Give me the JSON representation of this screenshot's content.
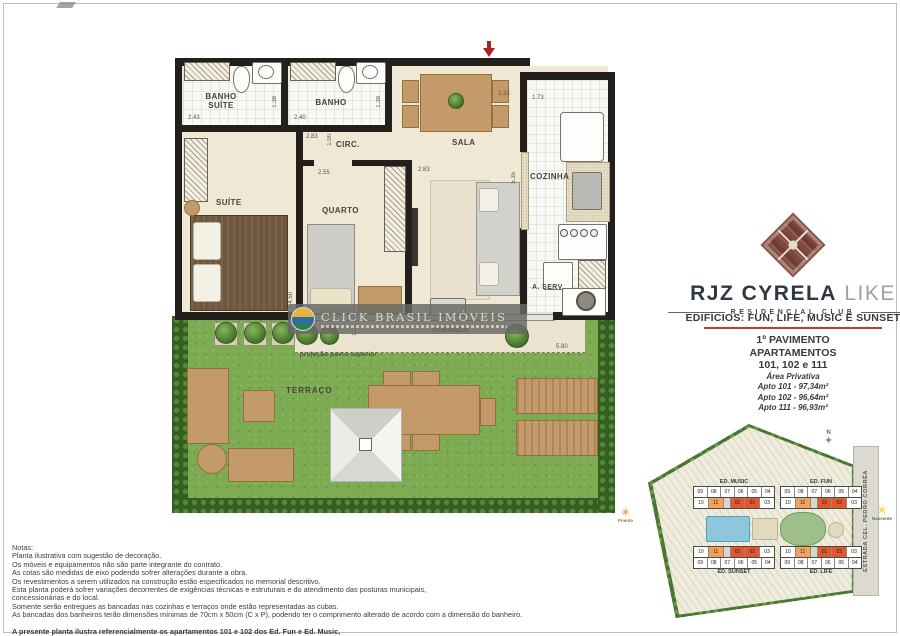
{
  "plan": {
    "rooms": {
      "banho_suite": "BANHO SUÍTE",
      "banho": "BANHO",
      "circ": "CIRC.",
      "sala": "SALA",
      "cozinha": "COZINHA",
      "suite": "SUÍTE",
      "quarto": "QUARTO",
      "a_serv": "A. SERV.",
      "varanda": "VARANDA",
      "terraco": "TERRAÇO"
    },
    "projection_label": "projeção pavto superior",
    "dims": {
      "banho_suite_w": "2.43",
      "banho_suite_d": "1.38",
      "banho_w": "2.40",
      "banho_d": "1.38",
      "circ_w": "2.83",
      "circ_d": "1.00",
      "quarto_opening": "2.55",
      "sala_w": "2.83",
      "sala_entry_w": "3.33",
      "cozinha_w": "1.73",
      "sala_depth": "5.35",
      "suite_depth": "4.50",
      "varanda_d": "1.03",
      "varanda_w": "5.80"
    }
  },
  "watermark": {
    "title": "CLICK BRASIL IMÓVEIS"
  },
  "branding": {
    "name_primary": "RJZ CYRELA",
    "name_secondary": "LIKE",
    "tagline": "RESIDENCIAL CLUB"
  },
  "info": {
    "buildings_line": "EDIFÍCIOS:  FUN, LIFE, MUSIC E SUNSET",
    "floor": "1º PAVIMENTO",
    "apartments_label": "APARTAMENTOS",
    "apartments_numbers": "101, 102 e 111",
    "area_title": "Área Privativa",
    "areas": [
      "Apto 101 - 97,34m²",
      "Apto 102 - 96,64m²",
      "Apto 111 - 96,93m²"
    ]
  },
  "sitemap": {
    "road": "ESTRADA CEL. PEDRO CORRÊA",
    "compass": "N",
    "sun_west": "Poente",
    "sun_east": "Nascente",
    "unit_rows": {
      "front": [
        "09",
        "08",
        "07",
        "06",
        "05",
        "04"
      ],
      "back": [
        "10",
        "11",
        "01",
        "02",
        "03"
      ]
    },
    "highlight_orange": [
      "11"
    ],
    "highlight_red": [
      "01",
      "02"
    ],
    "buildings": [
      {
        "name": "ED. MUSIC",
        "mirrored": false
      },
      {
        "name": "ED. FUN",
        "mirrored": false
      },
      {
        "name": "ED. SUNSET",
        "mirrored": true
      },
      {
        "name": "ED. LIFE",
        "mirrored": true
      }
    ]
  },
  "notes": {
    "title": "Notas:",
    "lines": [
      "Planta ilustrativa com sugestão de decoração.",
      "Os móveis e equipamentos não são parte integrante do contrato.",
      "As cotas são  medidas  de  eixo podendo sofrer alterações durante a obra.",
      "Os revestimentos a serem utilizados na construção estão especificados no memorial descritivo.",
      "Esta planta poderá sofrer variações decorrentes de exigências técnicas e estruturais e do atendimento das posturas municipais,",
      "concessionárias e do local.",
      "Somente serão entregues as bancadas nas cozinhas e terraços onde estão representadas as cubas.",
      "As bancadas dos banheiros terão dimensões mínimas de 70cm x 50cm (C x P), podendo ter o comprimento alterado de acordo com a dimensão do banheiro."
    ],
    "emphasis_lines": [
      "A presente planta ilustra referencialmente os apartamentos 101 e 102 dos Ed. Fun e Ed. Music,",
      "sendo que o apartamento 111 dos Ed. Fun e Ed. Music e os apartamentos 101, 102 e 111 dos Ed. Life e Ed. Sunset serão espelhados."
    ]
  },
  "colors": {
    "wall": "#23201c",
    "accent_red": "#c23b2e",
    "logo_maroon": "#7d4a41",
    "highlight_orange": "#f2a25c",
    "highlight_red": "#e2572f",
    "grass": "#7cab52"
  }
}
